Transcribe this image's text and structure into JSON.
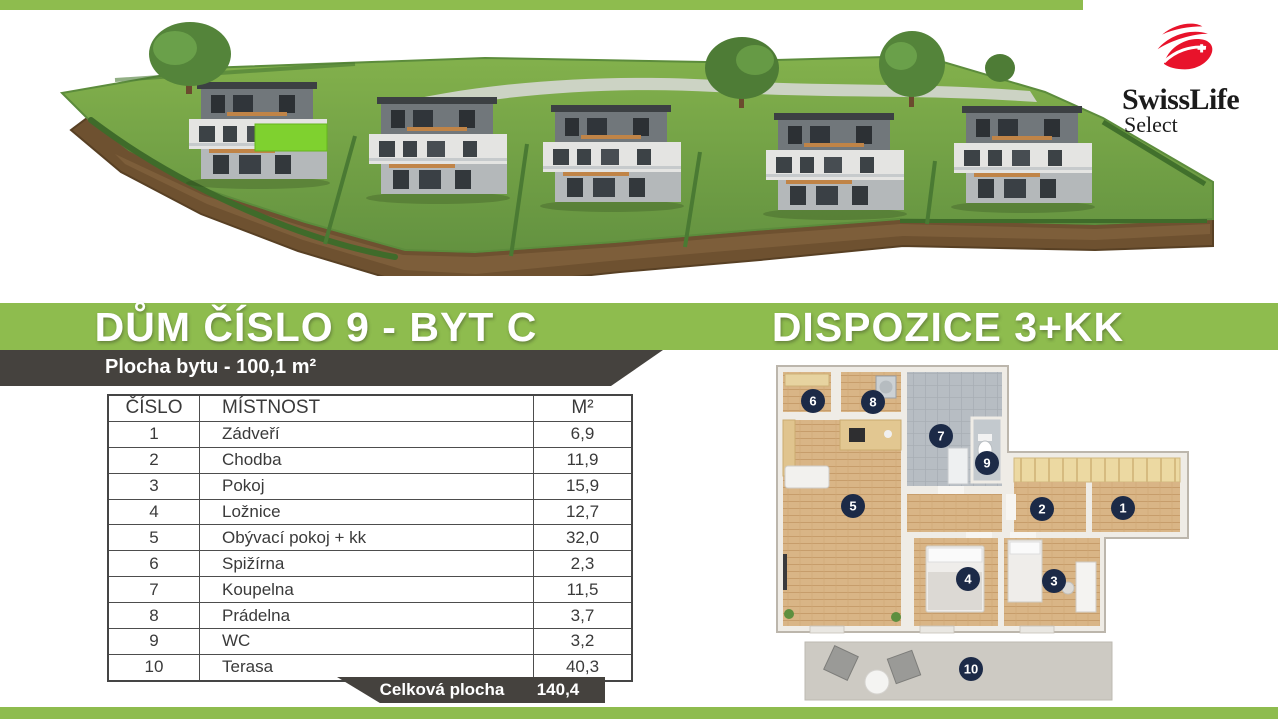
{
  "brand": {
    "name": "SwissLife",
    "sub": "Select"
  },
  "header": {
    "title_left": "DŮM ČÍSLO 9 - BYT C",
    "title_right": "DISPOZICE 3+KK",
    "apartment_area_label": "Plocha bytu - 100,1 m²"
  },
  "table": {
    "headers": [
      "ČÍSLO",
      "MÍSTNOST",
      "M²"
    ],
    "total_label": "Celková plocha",
    "total_value": "140,4"
  },
  "rooms": [
    {
      "number": "1",
      "name": "Zádveří",
      "area": "6,9"
    },
    {
      "number": "2",
      "name": "Chodba",
      "area": "11,9"
    },
    {
      "number": "3",
      "name": "Pokoj",
      "area": "15,9"
    },
    {
      "number": "4",
      "name": "Ložnice",
      "area": "12,7"
    },
    {
      "number": "5",
      "name": "Obývací pokoj + kk",
      "area": "32,0"
    },
    {
      "number": "6",
      "name": "Spižírna",
      "area": "2,3"
    },
    {
      "number": "7",
      "name": "Koupelna",
      "area": "11,5"
    },
    {
      "number": "8",
      "name": "Prádelna",
      "area": "3,7"
    },
    {
      "number": "9",
      "name": "WC",
      "area": "3,2"
    },
    {
      "number": "10",
      "name": "Terasa",
      "area": "40,3"
    }
  ],
  "colors": {
    "accent_green": "#8ebc4e",
    "dark_band": "#45423e",
    "room_marker_navy": "#1c2a47",
    "logo_red": "#e8132b"
  }
}
